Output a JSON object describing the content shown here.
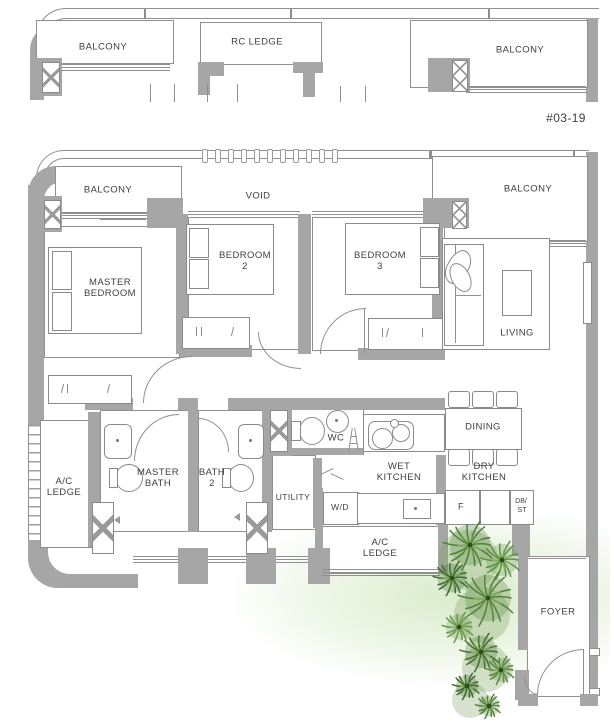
{
  "unit_label": "#03-19",
  "upper_floor": {
    "balcony_left": "BALCONY",
    "rc_ledge": "RC LEDGE",
    "balcony_right": "BALCONY"
  },
  "rooms": {
    "balcony_left": "BALCONY",
    "void": "VOID",
    "balcony_right": "BALCONY",
    "master_bedroom": "MASTER BEDROOM",
    "bedroom_2": "BEDROOM 2",
    "bedroom_3": "BEDROOM 3",
    "living": "LIVING",
    "dining": "DINING",
    "wc": "WC",
    "wet_kitchen": "WET KITCHEN",
    "dry_kitchen": "DRY KITCHEN",
    "master_bath": "MASTER BATH",
    "bath_2": "BATH 2",
    "utility": "UTILITY",
    "ac_ledge_left": "A/C LEDGE",
    "ac_ledge_kitchen": "A/C LEDGE",
    "foyer": "FOYER"
  },
  "fixtures": {
    "washer_dryer": "W/D",
    "fridge": "F",
    "db_line1": "DB/",
    "db_line2": "ST"
  },
  "icons": {
    "window_marker": "x-cross-window",
    "void_edge": "vent-slots",
    "foliage": "palm-trees"
  },
  "colors": {
    "wall": "#a6a6a6",
    "thin_line": "#8f8f8f",
    "text": "#3f3f3f",
    "foliage_dark": "#3e6b30",
    "foliage_mid": "#54823c",
    "foliage_light": "#6a9a4e",
    "lawn_wash": "#cde5b8"
  }
}
